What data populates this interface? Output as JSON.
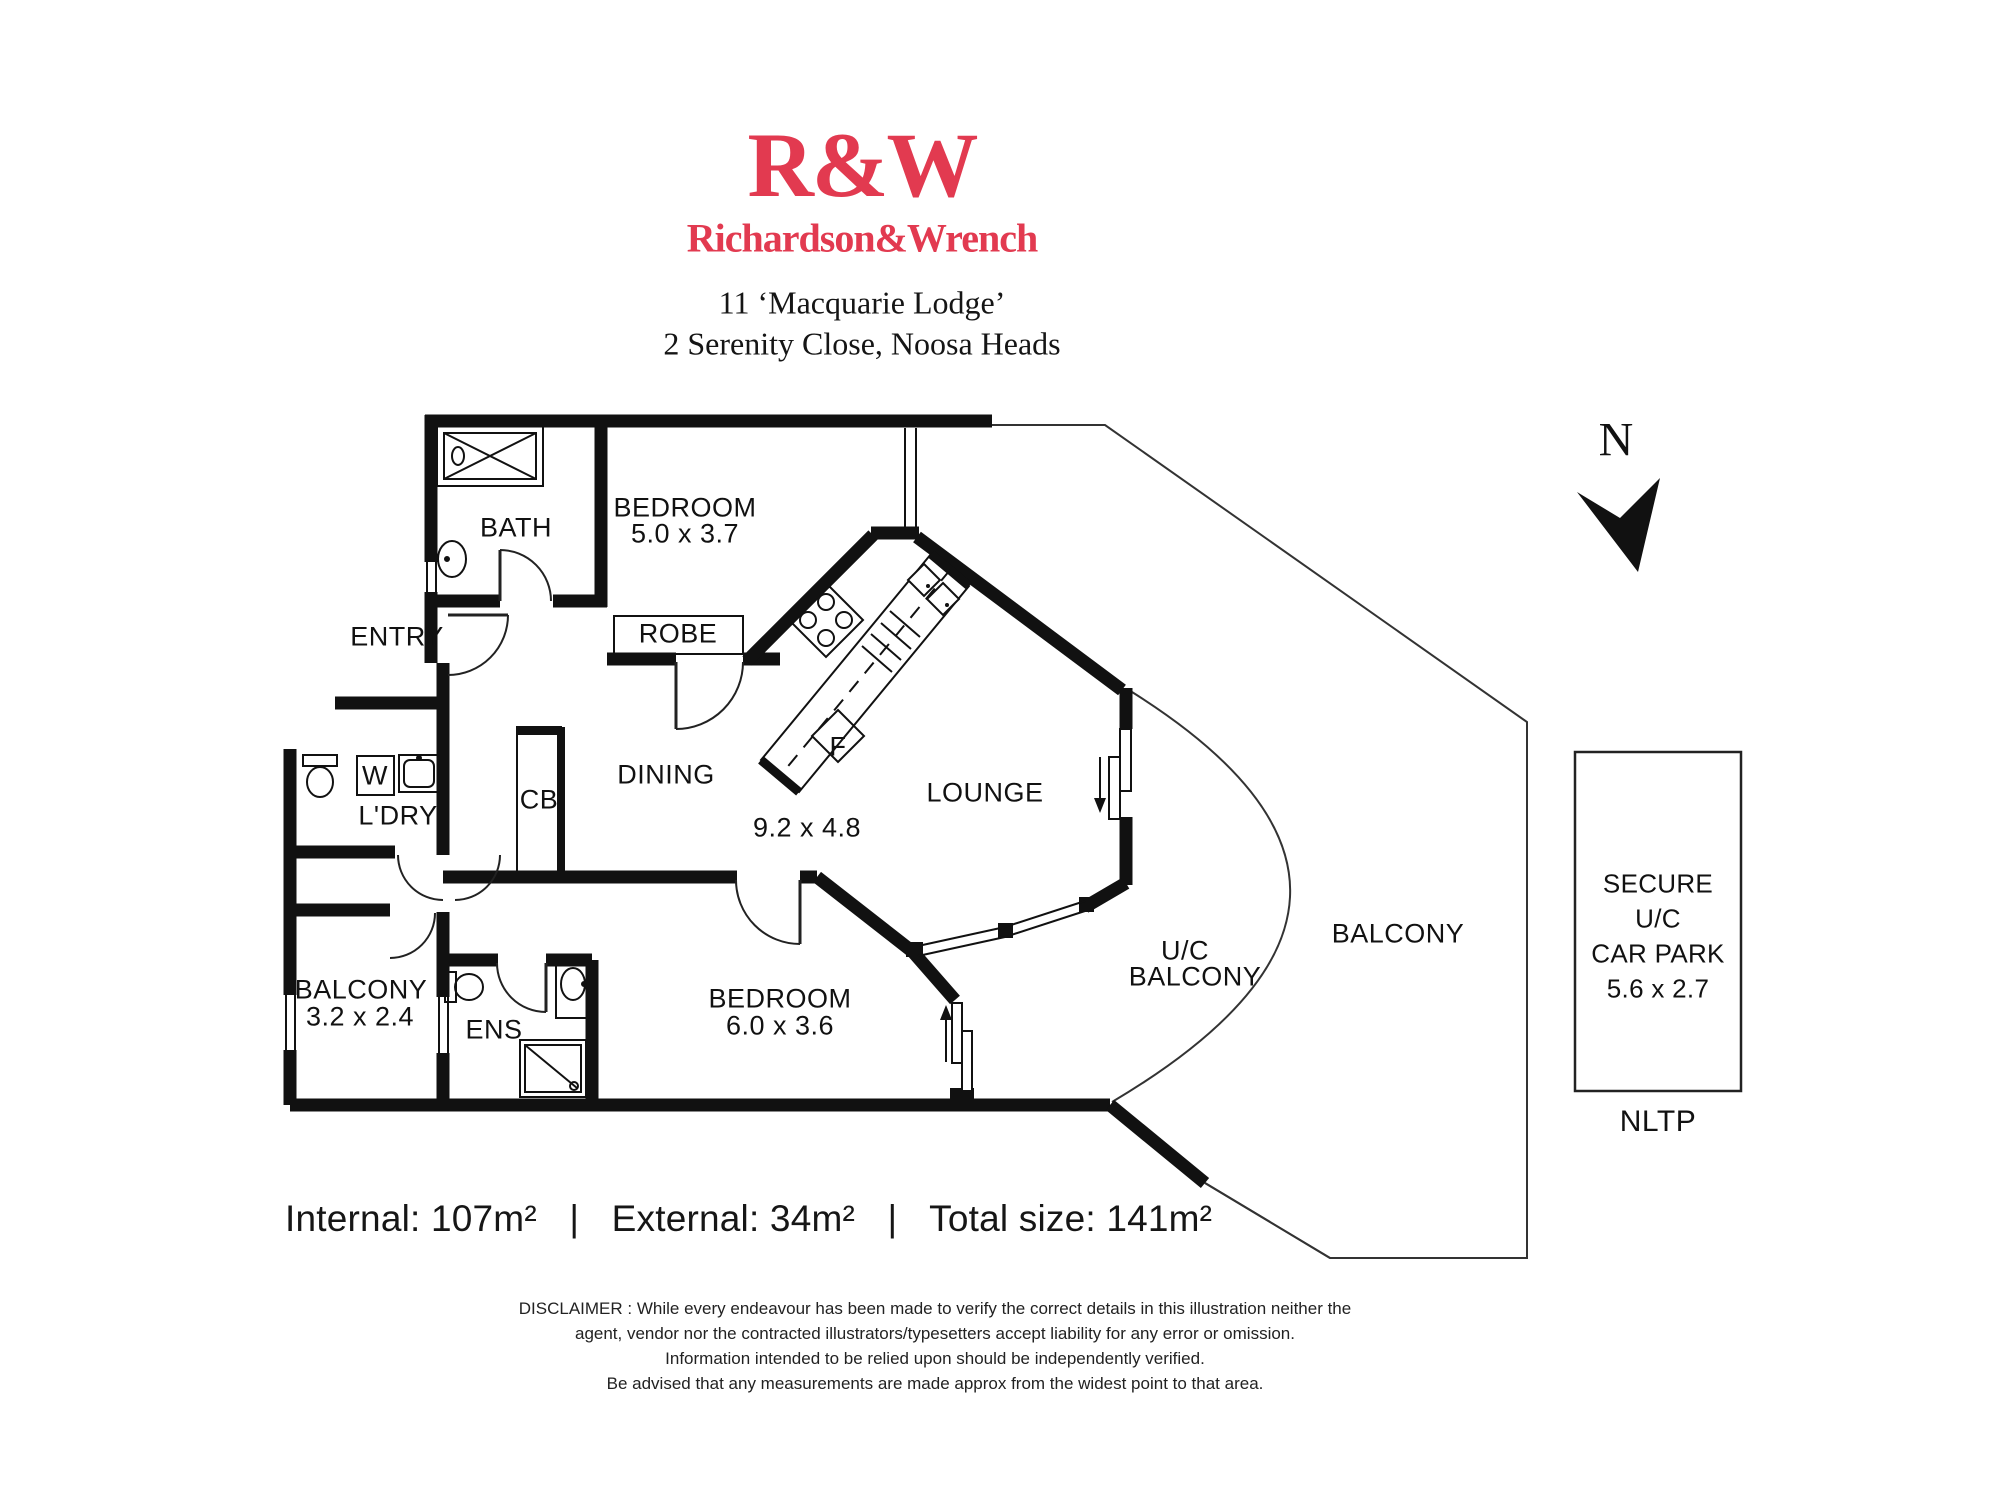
{
  "header": {
    "logo": "R&W",
    "brand": "Richardson&Wrench",
    "address_line1": "11 ‘Macquarie Lodge’",
    "address_line2": "2 Serenity Close, Noosa Heads"
  },
  "north_label": "N",
  "plan": {
    "bath": "BATH",
    "bedroom1": "BEDROOM",
    "bedroom1_dims": "5.0 x 3.7",
    "entry": "ENTRY",
    "robe": "ROBE",
    "fridge": "F",
    "dining": "DINING",
    "living_dims": "9.2 x 4.8",
    "lounge": "LOUNGE",
    "cupboard": "CB",
    "laundry": "L'DRY",
    "washer": "W",
    "balcony_small": "BALCONY",
    "balcony_small_dims": "3.2 x 2.4",
    "ens": "ENS",
    "bedroom2": "BEDROOM",
    "bedroom2_dims": "6.0 x 3.6",
    "uc_balcony_line1": "U/C",
    "uc_balcony_line2": "BALCONY",
    "balcony_main": "BALCONY",
    "carpark_line1": "SECURE",
    "carpark_line2": "U/C",
    "carpark_line3": "CAR PARK",
    "carpark_dims": "5.6 x 2.7",
    "nltp": "NLTP"
  },
  "areas": {
    "internal": "Internal: 107m²",
    "separator": "|",
    "external": "External: 34m²",
    "total": "Total size: 141m²"
  },
  "disclaimer": {
    "line1": "DISCLAIMER : While every endeavour has been made to verify the correct details in this illustration neither the",
    "line2": "agent, vendor nor the contracted illustrators/typesetters accept liability for any error or omission.",
    "line3": "Information intended to be relied upon should be independently verified.",
    "line4": "Be advised that any measurements are made approx from the widest point to that area."
  },
  "colors": {
    "brand_red": "#e23a50",
    "ink": "#111111"
  }
}
